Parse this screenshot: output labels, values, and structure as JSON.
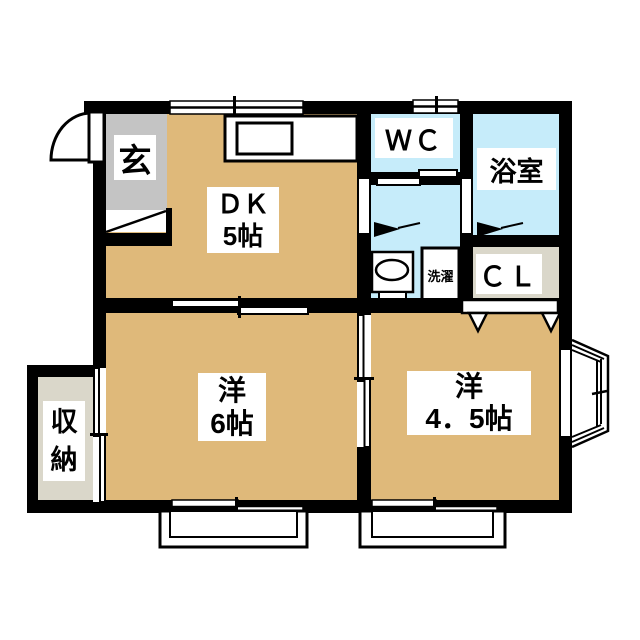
{
  "type": "japanese-apartment-floor-plan",
  "colors": {
    "room_tan": "#DFB97A",
    "wet_area_blue": "#C6ECFA",
    "entry_gray": "#C4C4C4",
    "closet_beige": "#DAD7CA",
    "wall_black": "#000000",
    "background": "#FFFFFF"
  },
  "rooms": {
    "entrance": {
      "label": "玄"
    },
    "dining_kitchen": {
      "name": "ＤＫ",
      "size": "5帖"
    },
    "toilet": {
      "label": "ＷＣ"
    },
    "bathroom": {
      "label": "浴室"
    },
    "closet": {
      "label": "ＣＬ"
    },
    "laundry": {
      "label": "洗濯"
    },
    "storage": {
      "char1": "収",
      "char2": "納"
    },
    "western_room_6": {
      "name": "洋",
      "size": "6帖"
    },
    "western_room_45": {
      "name": "洋",
      "size": "4．5帖"
    }
  }
}
